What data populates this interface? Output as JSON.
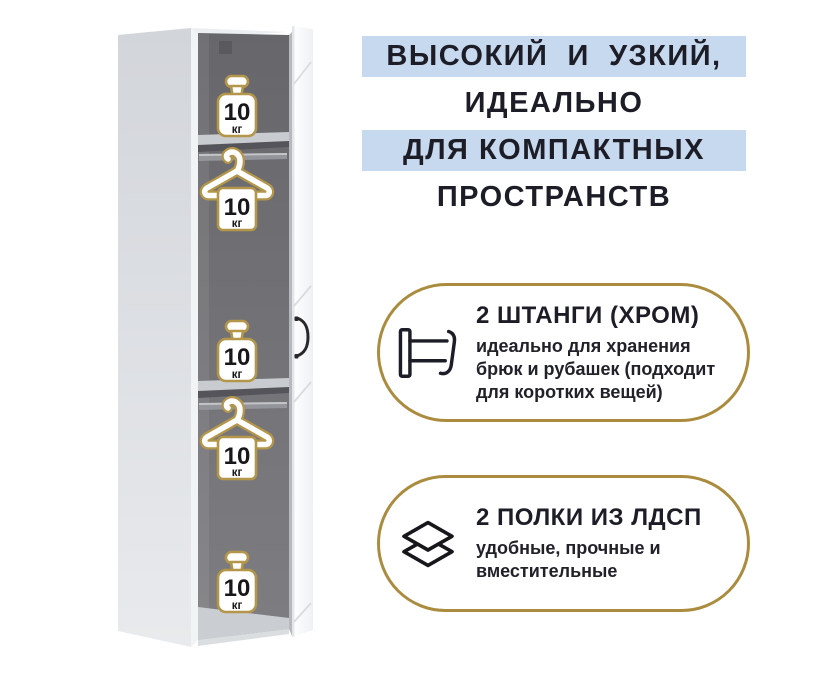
{
  "page": {
    "background": "#ffffff"
  },
  "colors": {
    "accent_gold": "#ab8c3f",
    "icon_gold": "#b4964a",
    "highlight_blue": "#c7d9ee",
    "heading_text": "#1d1d27"
  },
  "headline": {
    "lines": [
      {
        "text": "ВЫСОКИЙ  И  УЗКИЙ,",
        "highlighted": true
      },
      {
        "text": "ИДЕАЛЬНО",
        "highlighted": false
      },
      {
        "text": "ДЛЯ КОМПАКТНЫХ",
        "highlighted": true
      },
      {
        "text": "ПРОСТРАНСТВ",
        "highlighted": false
      }
    ]
  },
  "wardrobe": {
    "sections": [
      {
        "icon": "weight-icon",
        "location": "top-shelf",
        "capacity_value": "10",
        "capacity_unit": "кг"
      },
      {
        "icon": "hanger-icon",
        "location": "upper-rail",
        "capacity_value": "10",
        "capacity_unit": "кг"
      },
      {
        "icon": "weight-icon",
        "location": "middle-shelf",
        "capacity_value": "10",
        "capacity_unit": "кг"
      },
      {
        "icon": "hanger-icon",
        "location": "lower-rail",
        "capacity_value": "10",
        "capacity_unit": "кг"
      },
      {
        "icon": "weight-icon",
        "location": "bottom",
        "capacity_value": "10",
        "capacity_unit": "кг"
      }
    ]
  },
  "features": [
    {
      "icon": "clothes-rail-icon",
      "title": "2 ШТАНГИ (ХРОМ)",
      "description_lines": [
        "идеально для хранения",
        "брюк и рубашек (подходит",
        "для коротких вещей)"
      ]
    },
    {
      "icon": "shelves-icon",
      "title": "2 ПОЛКИ ИЗ ЛДСП",
      "description_lines": [
        "удобные, прочные и",
        "вместительные"
      ]
    }
  ]
}
